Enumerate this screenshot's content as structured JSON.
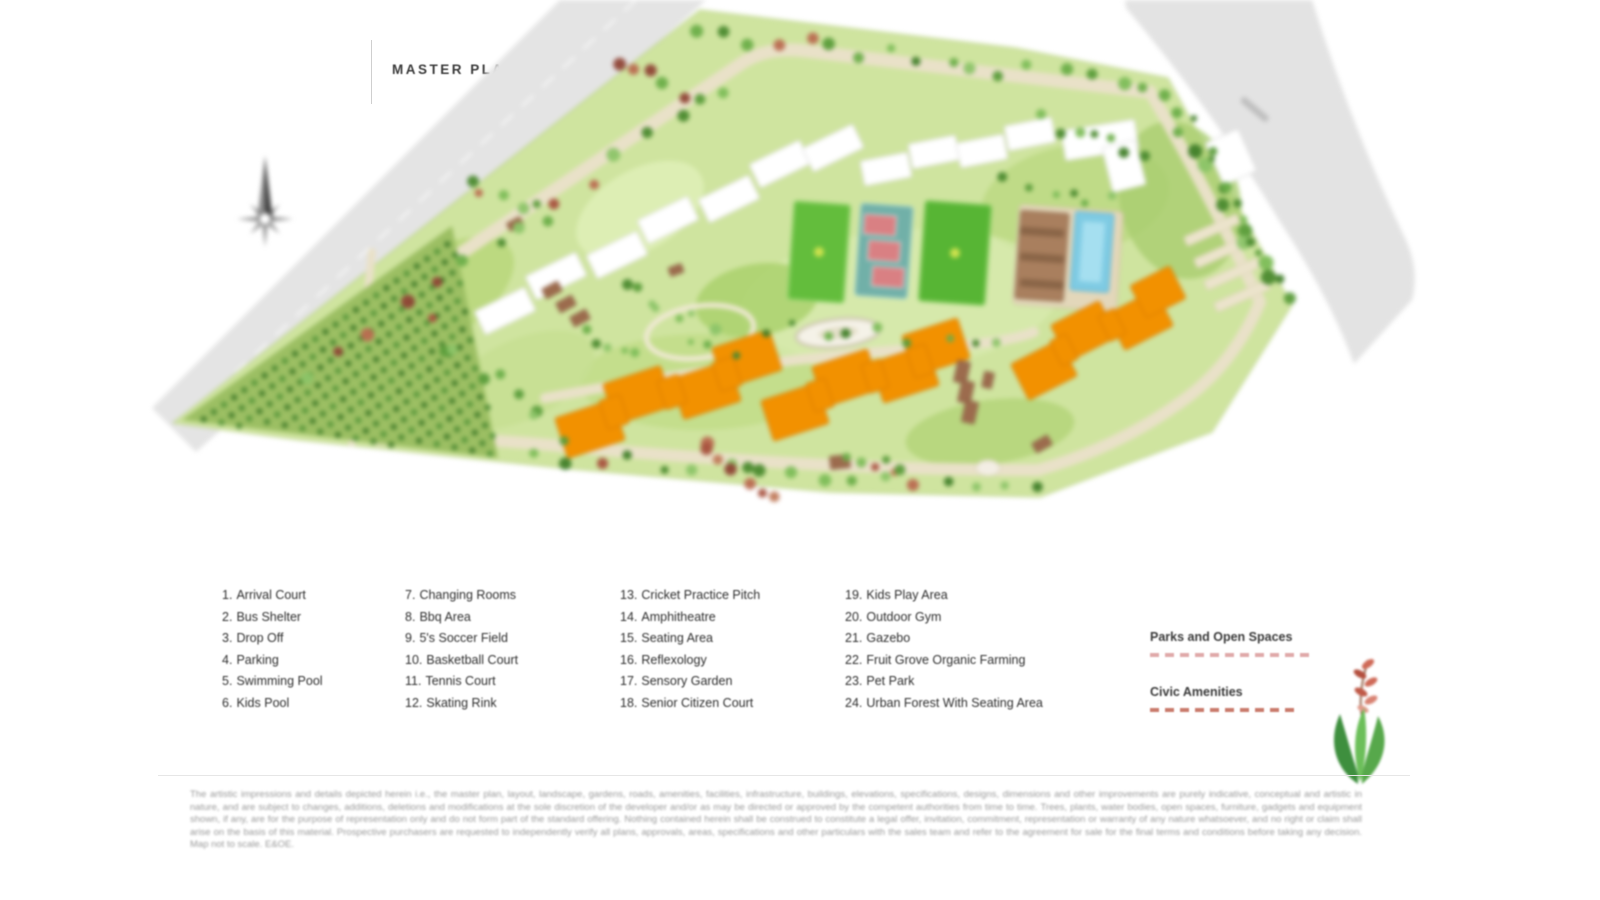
{
  "header": {
    "title": "MASTER PLAN"
  },
  "legend": {
    "columns": [
      {
        "items": [
          {
            "num": "1.",
            "label": "Arrival Court"
          },
          {
            "num": "2.",
            "label": "Bus Shelter"
          },
          {
            "num": "3.",
            "label": "Drop Off"
          },
          {
            "num": "4.",
            "label": "Parking"
          },
          {
            "num": "5.",
            "label": "Swimming Pool"
          },
          {
            "num": "6.",
            "label": "Kids Pool"
          }
        ]
      },
      {
        "items": [
          {
            "num": "7.",
            "label": "Changing Rooms"
          },
          {
            "num": "8.",
            "label": "Bbq Area"
          },
          {
            "num": "9.",
            "label": "5's Soccer Field"
          },
          {
            "num": "10.",
            "label": "Basketball Court"
          },
          {
            "num": "11.",
            "label": "Tennis Court"
          },
          {
            "num": "12.",
            "label": "Skating Rink"
          }
        ]
      },
      {
        "items": [
          {
            "num": "13.",
            "label": "Cricket Practice Pitch"
          },
          {
            "num": "14.",
            "label": "Amphitheatre"
          },
          {
            "num": "15.",
            "label": "Seating Area"
          },
          {
            "num": "16.",
            "label": "Reflexology"
          },
          {
            "num": "17.",
            "label": "Sensory Garden"
          },
          {
            "num": "18.",
            "label": "Senior Citizen Court"
          }
        ]
      },
      {
        "items": [
          {
            "num": "19.",
            "label": "Kids Play Area"
          },
          {
            "num": "20.",
            "label": "Outdoor Gym"
          },
          {
            "num": "21.",
            "label": "Gazebo"
          },
          {
            "num": "22.",
            "label": "Fruit Grove Organic Farming"
          },
          {
            "num": "23.",
            "label": "Pet Park"
          },
          {
            "num": "24.",
            "label": "Urban Forest With Seating Area"
          }
        ]
      }
    ]
  },
  "map_key": {
    "parks_label": "Parks and Open Spaces",
    "parks_dash_color": "#dfa9a9",
    "civic_label": "Civic Amenities",
    "civic_dash_color": "#c97b6c"
  },
  "map_colors": {
    "highlight_towers": "#f29100",
    "existing_towers": "#ffffff",
    "landscape": "#cfe49f",
    "external_roads": "#e4e4e4",
    "internal_roads": "#e9e1c8",
    "pool_water": "#7fcbe3"
  },
  "disclaimer": {
    "text": "The artistic impressions and details depicted herein i.e., the master plan, layout, landscape, gardens, roads, amenities, facilities, infrastructure, buildings, elevations, specifications, designs, dimensions and other improvements are purely indicative, conceptual and artistic in nature, and are subject to changes, additions, deletions and modifications at the sole discretion of the developer and/or as may be directed or approved by the competent authorities from time to time. Trees, plants, water bodies, open spaces, furniture, gadgets and equipment shown, if any, are for the purpose of representation only and do not form part of the standard offering. Nothing contained herein shall be construed to constitute a legal offer, invitation, commitment, representation or warranty of any nature whatsoever, and no right or claim shall arise on the basis of this material. Prospective purchasers are requested to independently verify all plans, approvals, areas, specifications and other particulars with the sales team and refer to the agreement for sale for the final terms and conditions before taking any decision. Map not to scale. E&OE."
  }
}
